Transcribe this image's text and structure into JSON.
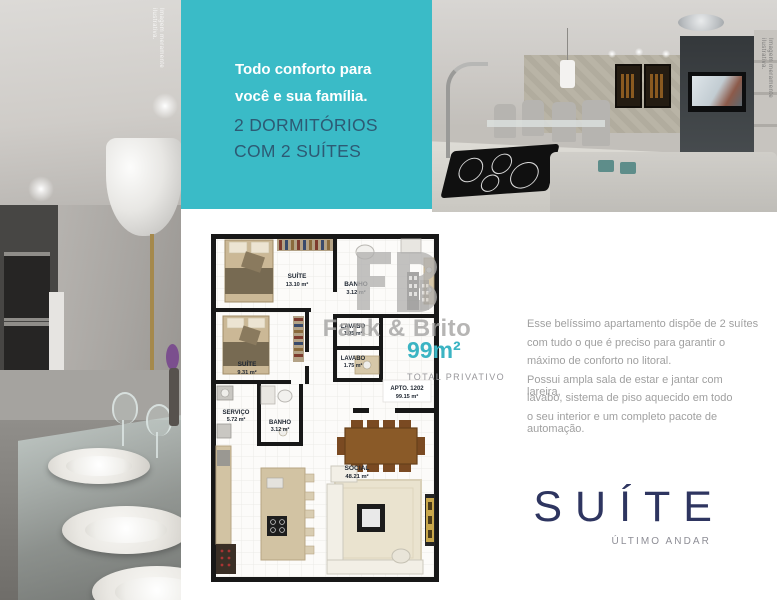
{
  "teal_panel": {
    "headline": "Todo conforto para você e sua família.",
    "subheadline": "2 DORMITÓRIOS COM 2 SUÍTES",
    "background_color": "#3abbc7",
    "headline_color": "#ffffff",
    "subheadline_color": "#2d5a74"
  },
  "photos": {
    "left_caption": "Imagem meramente ilustrativa.",
    "right_caption": "Imagem meramente ilustrativa."
  },
  "floor_plan": {
    "unit": {
      "name": "APTO. 1202",
      "area": "99.15 m²"
    },
    "suite1": {
      "name": "SUÍTE",
      "area": "13.10 m²"
    },
    "banho1": {
      "name": "BANHO",
      "area": "3.12 m²"
    },
    "lavabo1": {
      "name": "LAVABO",
      "area": "1.05 m²"
    },
    "suite2": {
      "name": "SUÍTE",
      "area": "9.31 m²"
    },
    "lavabo2": {
      "name": "LAVABO",
      "area": "1.75 m²"
    },
    "servico": {
      "name": "SERVIÇO",
      "area": "5.72 m²"
    },
    "banho2": {
      "name": "BANHO",
      "area": "3.12 m²"
    },
    "social": {
      "name": "SOCIAL",
      "area": "48.21 m²"
    }
  },
  "area_highlight": {
    "value": "99m²",
    "label": "TOTAL PRIVATIVO",
    "value_color": "#3bb4c3"
  },
  "watermark": {
    "monogram": "FB",
    "brand": "Fank & Brito"
  },
  "description": {
    "lines": [
      "Esse belíssimo apartamento dispõe de 2 suítes",
      "com tudo o que é preciso para garantir o",
      "máximo de conforto no litoral.",
      "Possui ampla sala de estar e jantar com lareira,",
      "lavabo, sistema de piso aquecido em todo",
      "o seu interior e um completo pacote de automação."
    ]
  },
  "footer": {
    "title": "SUÍTE",
    "subtitle": "ÚLTIMO ANDAR"
  },
  "colors": {
    "teal": "#3abbc7",
    "navy": "#2e3560",
    "gray_text": "#a0a0a0"
  }
}
